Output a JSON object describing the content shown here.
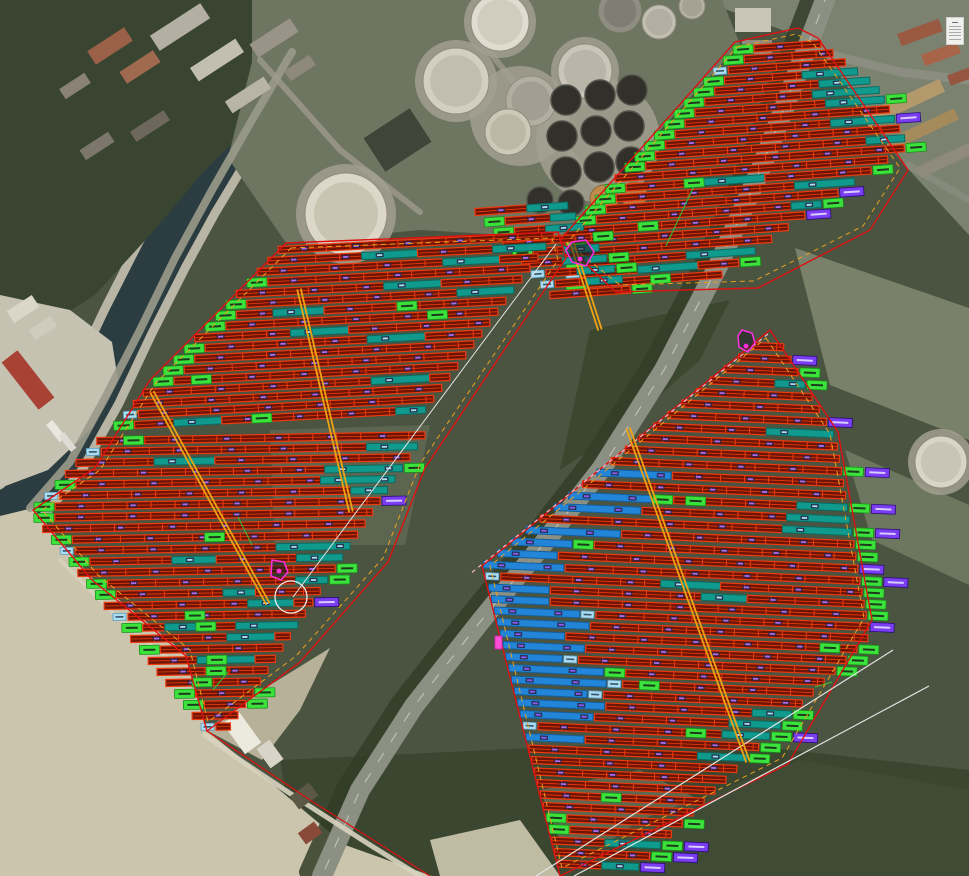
{
  "meta": {
    "view": "aerial-pv-plant-layout",
    "canvas": {
      "w": 969,
      "h": 876
    }
  },
  "seed": 20240613,
  "palette": {
    "base": "#4a5440",
    "water": "#2b3d41",
    "quay": "#b9b5a5",
    "redFill": "#6e1505",
    "redLine": "#ee3a0e",
    "tealFill": "#109a8e",
    "tealLine": "#0b6b60",
    "tealLabel": "#a8e2f2",
    "blueFill": "#2285d8",
    "blueLine": "#145f9e",
    "blueLabel": "#8a5cf0",
    "green": "#3ce23c",
    "greenDark": "#189018",
    "greenInner": "#1c3a1c",
    "cyanBox": "#aadcf2",
    "cyanBoxLine": "#5d9cc0",
    "purple": "#7a3df2",
    "purpleLine": "#2a0e78",
    "purpleInner": "#d8ccff",
    "stringLabel": "#b06ae8",
    "labelBg": "#2c2345",
    "cable": "#eda313",
    "boundaryRed": "#dd1111",
    "boundaryOrange": "#eaa21e",
    "surveyWhite": "#e4e4e4",
    "pinkDash": "#f5b8cc",
    "magenta": "#ff2fe0",
    "greenLink": "#35c035"
  },
  "background": {
    "polygons": [
      {
        "n": "forest-bottom",
        "p": "280,760 700,740 969,770 969,876 300,876",
        "f": "#3a4530",
        "o": 0.9
      },
      {
        "n": "urban-top-left",
        "p": "0,0 345,0 300,62 255,120 205,170 150,235 95,295 40,330 0,345",
        "f": "#3a4531",
        "o": 1
      },
      {
        "n": "east-urban-pavement",
        "p": "700,0 969,0 969,235 900,160 815,42",
        "f": "#7c8270",
        "o": 1
      },
      {
        "n": "east-field-1",
        "p": "795,248 969,308 969,440 830,385",
        "f": "#79816a",
        "o": 1
      },
      {
        "n": "east-field-2",
        "p": "845,450 969,505 969,585 872,540",
        "f": "#6d7760",
        "o": 1
      },
      {
        "n": "forest-mid-strip",
        "p": "590,330 730,300 700,360 620,430 560,470",
        "f": "#3b462f",
        "o": 0.9
      },
      {
        "n": "marina-quay",
        "p": "0,295 70,310 112,342 118,380 92,428 48,470 0,488",
        "f": "#c6c2b1",
        "o": 1
      },
      {
        "n": "tank-farm-ground",
        "p": "252,0 722,0 740,44 560,238 420,230 286,243 228,158 252,62",
        "f": "#6e7560",
        "o": 1
      },
      {
        "n": "field-c-bare-patch",
        "p": "270,430 430,425 405,545 275,545",
        "f": "#5f6852",
        "o": 0.85
      },
      {
        "n": "sand-main",
        "p": "0,516 33,508 92,578 186,654 206,730 258,772 345,845 432,876 0,876",
        "f": "#ccc5ad",
        "o": 1
      },
      {
        "n": "sand-patch-east",
        "p": "206,730 262,690 330,648 300,710 262,760",
        "f": "#c2bba2",
        "o": 0.9
      },
      {
        "n": "sand-patch-bottom",
        "p": "430,840 520,820 560,876 440,876",
        "f": "#cfc8b0",
        "o": 0.9
      },
      {
        "n": "clearing-bottom-mid",
        "p": "540,790 640,770 700,800 660,845 560,840",
        "f": "#66715a",
        "o": 0.8
      },
      {
        "n": "green-bottom-right",
        "p": "560,876 640,820 800,760 969,790 969,876",
        "f": "#414c36",
        "o": 0.85
      }
    ],
    "roads": [
      {
        "n": "road-treeline",
        "p": "812,-12 784,62 746,162 702,262 648,366 586,464 524,544 464,618 398,702 344,786 306,872",
        "w": 14,
        "c": "#333d28",
        "o": 0.85
      },
      {
        "n": "main-road",
        "p": "828,-8 800,66 762,166 718,266 664,370 602,468 540,548 480,622 414,706 360,790 322,876",
        "w": 20,
        "c": "#8c9082",
        "o": 1
      },
      {
        "n": "main-road-dashes",
        "p": "828,-8 800,66 762,166 718,266 664,370 602,468 540,548 480,622 414,706 360,790 322,876",
        "w": 1.2,
        "c": "#c2c5b8",
        "o": 0.9,
        "d": "10 14"
      },
      {
        "n": "branch-road-ne",
        "p": "820,52 900,72 969,80",
        "w": 9,
        "c": "#8a8d7f",
        "o": 1
      },
      {
        "n": "branch-road-e",
        "p": "908,165 969,200",
        "w": 7,
        "c": "#8a8d7f",
        "o": 0.8
      },
      {
        "n": "quay-road",
        "p": "292,52 252,120 212,190 175,258 140,330 105,398 70,462 30,508",
        "w": 8,
        "c": "#9a9a8b",
        "o": 0.9
      },
      {
        "n": "farm-lane-1",
        "p": "260,60 340,150 420,212",
        "w": 6,
        "c": "#9d9b8c",
        "o": 0.8
      },
      {
        "n": "farm-lane-2",
        "p": "480,40 560,140 600,190",
        "w": 6,
        "c": "#9d9b8c",
        "o": 0.8
      },
      {
        "n": "sand-path",
        "p": "205,735 240,760 300,800 370,845 420,876",
        "w": 5,
        "c": "#d8d3c0",
        "o": 0.9
      },
      {
        "n": "dune-path",
        "p": "60,560 120,620 170,660",
        "w": 4,
        "c": "#d8d3c0",
        "o": 0.7
      }
    ],
    "buildings": [
      [
        88,
        38,
        44,
        16,
        -33,
        "#9a6148"
      ],
      [
        120,
        60,
        40,
        14,
        -33,
        "#a06a50"
      ],
      [
        60,
        80,
        30,
        12,
        -33,
        "#8a8274"
      ],
      [
        150,
        18,
        60,
        18,
        -33,
        "#b3afa2"
      ],
      [
        190,
        52,
        54,
        16,
        -33,
        "#c2beb0"
      ],
      [
        225,
        88,
        46,
        14,
        -33,
        "#b8b4a6"
      ],
      [
        250,
        30,
        48,
        16,
        -33,
        "#9a9488"
      ],
      [
        285,
        62,
        30,
        12,
        -33,
        "#8f897c"
      ],
      [
        130,
        120,
        40,
        12,
        -33,
        "#6e675c"
      ],
      [
        80,
        140,
        34,
        12,
        -33,
        "#7d766a"
      ],
      [
        8,
        302,
        30,
        14,
        -33,
        "#dad6c8"
      ],
      [
        30,
        322,
        26,
        12,
        -33,
        "#cfcbbd"
      ],
      [
        18,
        350,
        20,
        60,
        -38,
        "#a84235"
      ],
      [
        52,
        420,
        8,
        22,
        -38,
        "#e8e8e0"
      ],
      [
        64,
        432,
        7,
        20,
        -38,
        "#dcdcd4"
      ],
      [
        735,
        8,
        36,
        24,
        0,
        "#c9c5b7"
      ],
      [
        742,
        40,
        30,
        14,
        0,
        "#918b7d"
      ],
      [
        898,
        26,
        44,
        13,
        -20,
        "#9a5a42"
      ],
      [
        922,
        48,
        38,
        12,
        -20,
        "#a86448"
      ],
      [
        948,
        70,
        30,
        11,
        -20,
        "#965640"
      ],
      [
        862,
        96,
        84,
        14,
        -25,
        "#b4996c"
      ],
      [
        884,
        124,
        76,
        12,
        -25,
        "#a58a5c"
      ],
      [
        916,
        154,
        60,
        12,
        -25,
        "#8f8a7c"
      ],
      [
        370,
        120,
        55,
        40,
        -33,
        "#3f4538"
      ],
      [
        232,
        714,
        20,
        38,
        -36,
        "#eceade"
      ],
      [
        262,
        742,
        16,
        24,
        -36,
        "#d8d5c8"
      ],
      [
        292,
        788,
        24,
        16,
        -36,
        "#5c5848"
      ],
      [
        300,
        826,
        20,
        14,
        -36,
        "#8a4a3a"
      ]
    ],
    "tanks": {
      "pads": [
        [
          346,
          214,
          50
        ],
        [
          456,
          81,
          41
        ],
        [
          500,
          22,
          36
        ],
        [
          520,
          116,
          50
        ],
        [
          585,
          71,
          34
        ],
        [
          598,
          140,
          62
        ],
        [
          941,
          462,
          33
        ]
      ],
      "white": [
        [
          346,
          214,
          41,
          "#dcd7c9",
          "#cac4b2"
        ],
        [
          456,
          81,
          33,
          "#d2cec0",
          "#c2bdae"
        ],
        [
          500,
          22,
          29,
          "#e0dcd0",
          "#d0ccbe"
        ],
        [
          531,
          101,
          25,
          "#b2afa2",
          "#a29f92"
        ],
        [
          508,
          132,
          23,
          "#cdc8b8",
          "#bdb8a8"
        ],
        [
          585,
          71,
          27,
          "#c9c5b8",
          "#b9b5a8"
        ],
        [
          620,
          11,
          21,
          "#8f8e85",
          "#7f7e75"
        ],
        [
          659,
          22,
          17,
          "#c2beb1",
          "#b2aea1"
        ],
        [
          692,
          6,
          13,
          "#b5b1a3",
          "#a5a193"
        ],
        [
          941,
          462,
          26,
          "#d8d4c6",
          "#c8c4b6"
        ]
      ],
      "dark": [
        [
          566,
          100,
          15
        ],
        [
          600,
          95,
          15
        ],
        [
          632,
          90,
          15
        ],
        [
          562,
          136,
          15
        ],
        [
          596,
          131,
          15
        ],
        [
          629,
          126,
          15
        ],
        [
          566,
          172,
          15
        ],
        [
          599,
          167,
          15
        ],
        [
          631,
          162,
          15
        ],
        [
          540,
          200,
          13
        ],
        [
          571,
          203,
          13
        ]
      ],
      "tan": [
        [
          604,
          199,
          14,
          "#c08b4d"
        ],
        [
          634,
          195,
          13,
          "#b27f42"
        ]
      ]
    }
  },
  "overlay": {
    "boundaries": [
      {
        "n": "field-north-red",
        "p": "735,42 798,28 818,38 908,170 870,230 758,288 616,292 560,240",
        "c": "red",
        "w": 1.4,
        "closed": true
      },
      {
        "n": "field-north-orange",
        "p": "737,47 796,34 813,43 900,168 863,226 754,281 620,285 567,243",
        "c": "orange",
        "w": 1,
        "closed": true,
        "d": "5 4"
      },
      {
        "n": "field-west-red",
        "p": "286,243 558,232 566,258 425,468 388,562 300,662 207,731 186,656 92,580 33,510 95,468 150,380",
        "c": "red",
        "w": 1.4,
        "closed": true
      },
      {
        "n": "field-west-orange",
        "p": "291,248 552,238 558,260 420,464 383,558 296,656 208,722 190,650 98,575 42,510 100,470 155,384",
        "c": "orange",
        "w": 1,
        "closed": true,
        "d": "5 4"
      },
      {
        "n": "field-southeast-red",
        "p": "770,330 838,432 872,620 788,764 560,876 482,566",
        "c": "red",
        "w": 1.4,
        "closed": true
      },
      {
        "n": "field-southeast-orange",
        "p": "766,338 830,434 864,618 782,758 562,868 490,566",
        "c": "orange",
        "w": 1,
        "closed": true,
        "d": "5 4"
      },
      {
        "n": "site-boundary-ext",
        "p": "207,731 310,800 430,876",
        "c": "red",
        "w": 1.2,
        "closed": false
      },
      {
        "n": "road-edge-pink-dashed",
        "p": "768,334 470,574",
        "c": "pink",
        "w": 1.2,
        "closed": false,
        "d": "4 4"
      },
      {
        "n": "survey-line-nw",
        "p": "556,244 293,597",
        "c": "white",
        "w": 1,
        "closed": false
      },
      {
        "n": "survey-line-se-1",
        "p": "893,650 536,876",
        "c": "white",
        "w": 1.2,
        "closed": false
      },
      {
        "n": "survey-line-se-2",
        "p": "929,686 574,876",
        "c": "white",
        "w": 1.2,
        "closed": false
      }
    ],
    "cables": [
      {
        "n": "cable-route-1",
        "x1": 152,
        "y1": 392,
        "x2": 268,
        "y2": 604
      },
      {
        "n": "cable-route-2",
        "x1": 299,
        "y1": 289,
        "x2": 351,
        "y2": 512
      },
      {
        "n": "cable-route-3",
        "x1": 628,
        "y1": 428,
        "x2": 748,
        "y2": 762
      },
      {
        "n": "cable-route-4",
        "x1": 572,
        "y1": 243,
        "x2": 600,
        "y2": 330
      }
    ],
    "circle_marker": {
      "cx": 291,
      "cy": 597,
      "r": 16
    },
    "magenta_markers": [
      {
        "n": "station-marker-1",
        "p": "572,242 586,240 594,252 586,266 572,262 566,250",
        "dot": [
          580,
          259
        ]
      },
      {
        "n": "station-marker-2",
        "p": "742,330 752,333 755,343 748,352 739,347 738,336",
        "dot": [
          746,
          346
        ]
      },
      {
        "n": "station-marker-3",
        "p": "272,560 284,562 288,572 281,580 271,576",
        "dot": [
          279,
          571
        ]
      }
    ],
    "magenta_rects": [
      [
        495,
        636,
        7,
        13
      ]
    ],
    "green_links": [
      "694,186 666,246",
      "238,517 252,545",
      "213,690 228,672",
      "815,687 832,682"
    ]
  },
  "fields": [
    {
      "id": "north",
      "tilt": -4,
      "y0": 50,
      "y1": 292,
      "step": 10.7,
      "rowH": 7,
      "left": [
        {
          "maxY": 232,
          "x": 735,
          "slope": -0.92,
          "refY": 48
        },
        {
          "maxY": 9999,
          "x": 566,
          "slope": 0,
          "refY": 232
        }
      ],
      "right": [
        {
          "maxY": 100,
          "x": 798,
          "slope": 1.15,
          "refY": 30
        },
        {
          "maxY": 165,
          "x": 878,
          "slope": 0.48,
          "refY": 100
        },
        {
          "maxY": 9999,
          "x": 909,
          "slope": -1.55,
          "refY": 165
        }
      ],
      "style": {
        "leftGreen": 0.75,
        "rightTeal": 0.42,
        "tealMin": 30,
        "tealMax": 75,
        "rightGreen": 0.15,
        "midGreen": 0.12,
        "cyanBox": 0.15,
        "purpleBox": 0.05,
        "midTeal": 0.1
      }
    },
    {
      "id": "strip",
      "tilt": -4,
      "y0": 212,
      "y1": 300,
      "step": 10.4,
      "rowH": 7,
      "left": [
        {
          "maxY": 9999,
          "x": 475,
          "slope": 0.9,
          "refY": 212
        }
      ],
      "right": [
        {
          "maxY": 9999,
          "x": 568,
          "slope": 0.75,
          "refY": 212
        }
      ],
      "style": {
        "leftGreen": 0.3,
        "rightTeal": 0.5,
        "tealMin": 25,
        "tealMax": 50,
        "rightGreen": 0.35,
        "midGreen": 0.2,
        "cyanBox": 0.2,
        "purpleBox": 0,
        "midTeal": 0.2
      }
    },
    {
      "id": "west-upper",
      "tilt": -3,
      "y0": 250,
      "y1": 432,
      "step": 11,
      "rowH": 7,
      "left": [
        {
          "maxY": 380,
          "x": 283,
          "slope": -0.95,
          "refY": 245
        },
        {
          "maxY": 9999,
          "x": 155,
          "slope": -0.9,
          "refY": 380
        }
      ],
      "right": [
        {
          "maxY": 9999,
          "x": 563,
          "slope": -0.728,
          "refY": 238
        }
      ],
      "style": {
        "leftGreen": 0.55,
        "rightTeal": 0.3,
        "tealMin": 30,
        "tealMax": 70,
        "rightGreen": 0.1,
        "midGreen": 0.3,
        "cyanBox": 0.22,
        "purpleBox": 0,
        "midTeal": 0.35
      }
    },
    {
      "id": "west-lower",
      "tilt": -1,
      "y0": 441,
      "y1": 727,
      "step": 11,
      "rowH": 7,
      "left": [
        {
          "maxY": 512,
          "x": 283,
          "slope": -0.95,
          "refY": 245
        },
        {
          "maxY": 9999,
          "x": 29,
          "slope": 0.8,
          "refY": 512
        }
      ],
      "right": [
        {
          "maxY": 9999,
          "x": 563,
          "slope": -0.68,
          "refY": 238
        }
      ],
      "style": {
        "leftGreen": 0.45,
        "rightTeal": 0.45,
        "tealMin": 30,
        "tealMax": 80,
        "rightGreen": 0.3,
        "midGreen": 0.25,
        "cyanBox": 0.2,
        "purpleBox": 0.04,
        "midTeal": 0.3
      }
    },
    {
      "id": "southeast",
      "tilt": 2.5,
      "y0": 346,
      "y1": 872,
      "step": 11.5,
      "rowH": 7,
      "left": [
        {
          "maxY": 565,
          "x": 770,
          "slope": -1.232,
          "refY": 332
        },
        {
          "maxY": 9999,
          "x": 483,
          "slope": 0.25,
          "refY": 565
        }
      ],
      "right": [
        {
          "maxY": 430,
          "x": 775,
          "slope": 0.62,
          "refY": 332
        },
        {
          "maxY": 620,
          "x": 836,
          "slope": 0.18,
          "refY": 430
        },
        {
          "maxY": 9999,
          "x": 870,
          "slope": -0.95,
          "refY": 620
        }
      ],
      "style": {
        "leftGreen": 0.1,
        "rightTeal": 0.32,
        "tealMin": 30,
        "tealMax": 70,
        "rightGreen": 0.55,
        "midGreen": 0.08,
        "cyanBox": 0.12,
        "purpleBox": 0.28,
        "midTeal": 0.05,
        "blueZone": {
          "y0": 470,
          "y1": 745,
          "prob": 0.85,
          "lenMin": 55,
          "lenMax": 95
        }
      }
    }
  ],
  "icons": {
    "layers_list": {
      "name": "layers-list-icon",
      "lines": 6
    }
  }
}
